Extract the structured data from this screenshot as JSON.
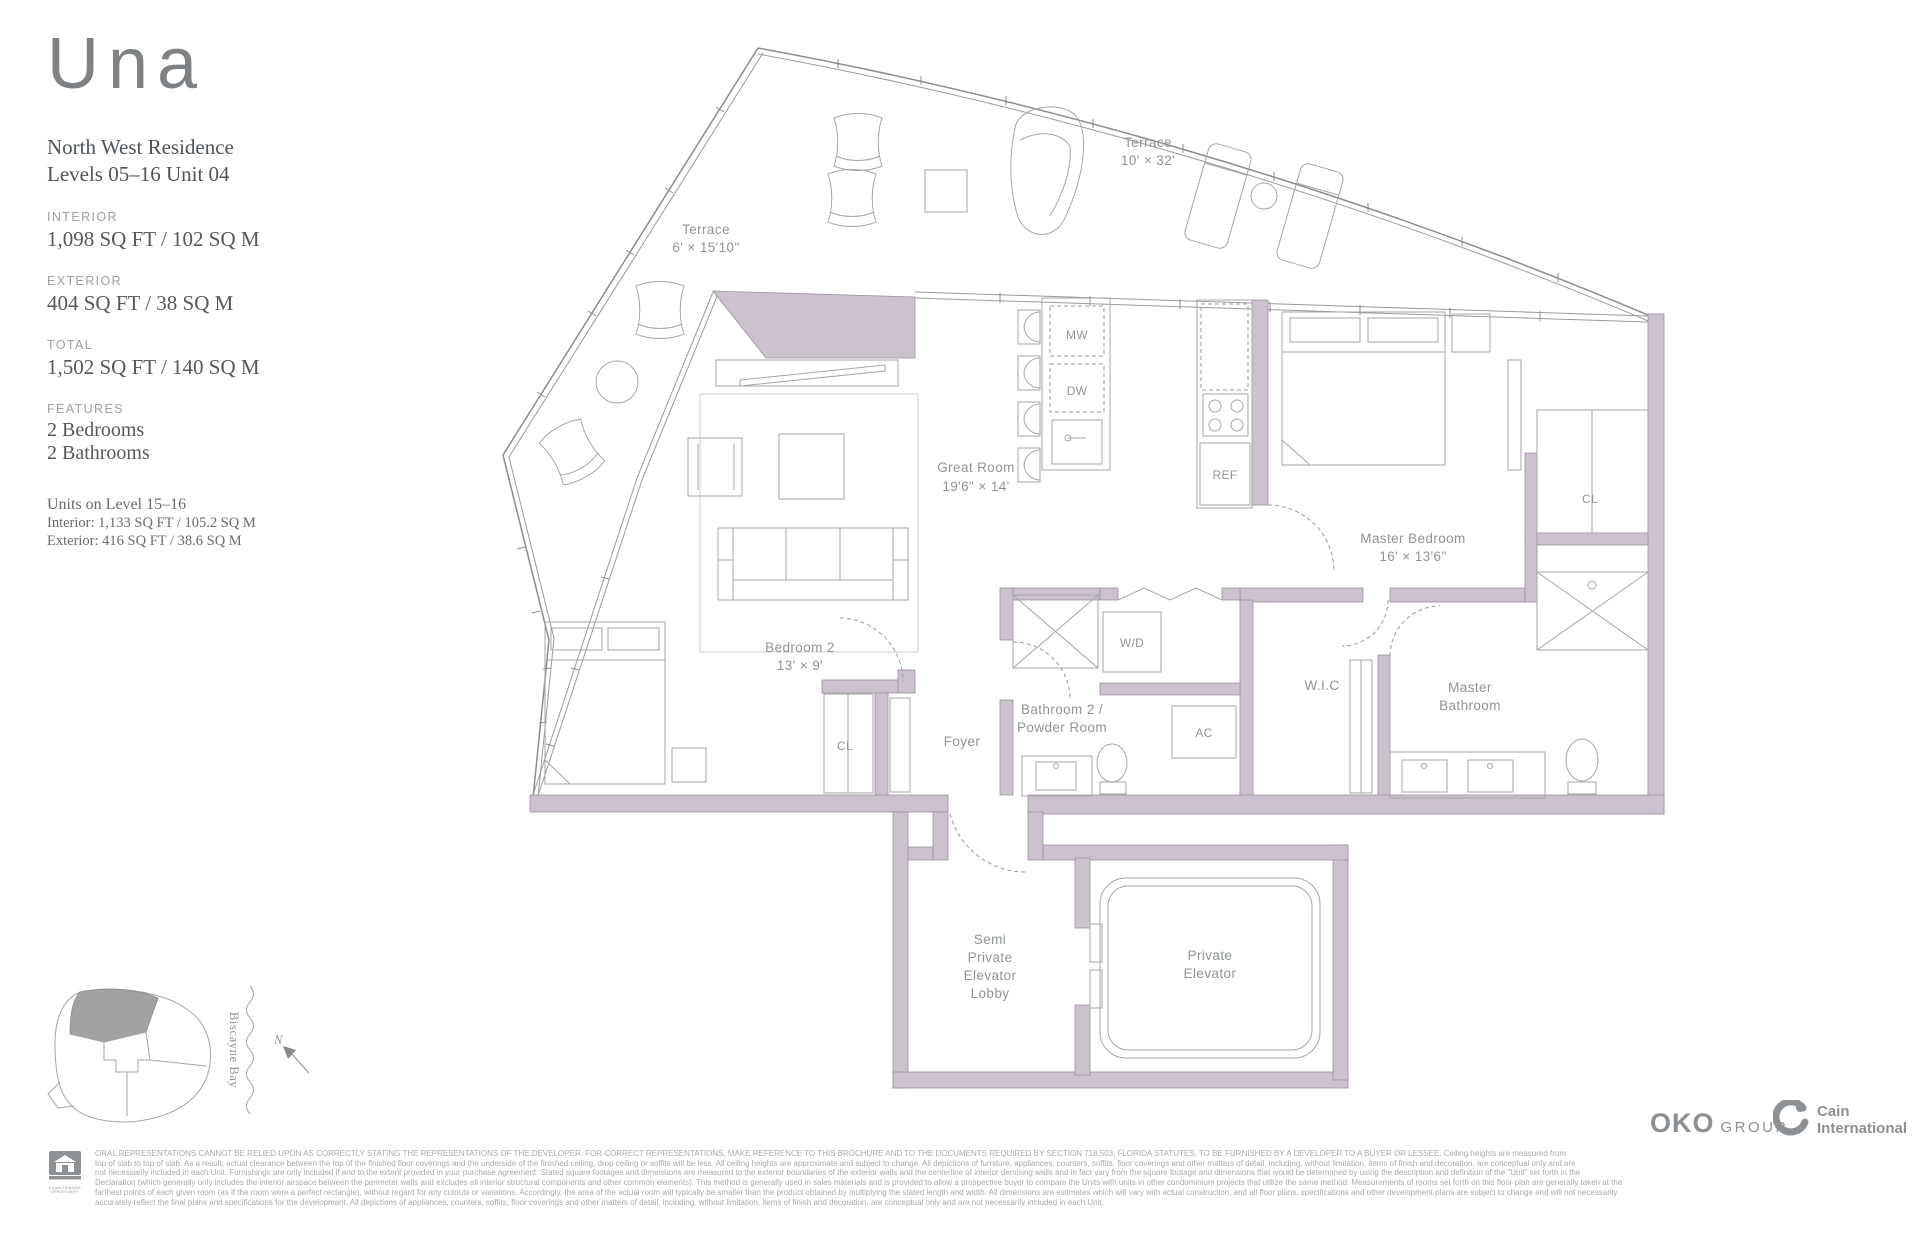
{
  "colors": {
    "wall_fill": "#ccc2cd",
    "line": "#9a9a9a",
    "label_text": "#8f9497",
    "panel_text": "#55595d"
  },
  "sidebar": {
    "logo": "Una",
    "residence_name": "North West Residence",
    "residence_levels": "Levels 05–16 Unit 04",
    "interior_label": "INTERIOR",
    "interior_value": "1,098 SQ FT / 102 SQ M",
    "exterior_label": "EXTERIOR",
    "exterior_value": "404 SQ FT / 38 SQ M",
    "total_label": "TOTAL",
    "total_value": "1,502 SQ FT / 140 SQ M",
    "features_label": "FEATURES",
    "feature_1": "2 Bedrooms",
    "feature_2": "2 Bathrooms",
    "units_note_title": "Units on Level 15–16",
    "units_note_interior": "Interior: 1,133 SQ FT / 105.2 SQ M",
    "units_note_exterior": "Exterior: 416 SQ FT / 38.6 SQ M"
  },
  "plan": {
    "terrace_left_name": "Terrace",
    "terrace_left_dim": "6' × 15'10\"",
    "terrace_top_name": "Terrace",
    "terrace_top_dim": "10' × 32'",
    "great_room_name": "Great Room",
    "great_room_dim": "19'6\" × 14'",
    "master_bedroom_name": "Master Bedroom",
    "master_bedroom_dim": "16' × 13'6\"",
    "bedroom2_name": "Bedroom 2",
    "bedroom2_dim": "13' × 9'",
    "mw": "MW",
    "dw": "DW",
    "ref": "REF",
    "wd": "W/D",
    "ac": "AC",
    "wic": "W.I.C",
    "cl_bedroom2": "CL",
    "cl_master": "CL",
    "foyer": "Foyer",
    "bath2_line1": "Bathroom 2 /",
    "bath2_line2": "Powder Room",
    "master_bath_line1": "Master",
    "master_bath_line2": "Bathroom",
    "lobby_line1": "Semi",
    "lobby_line2": "Private",
    "lobby_line3": "Elevator",
    "lobby_line4": "Lobby",
    "elevator_line1": "Private",
    "elevator_line2": "Elevator"
  },
  "site_map": {
    "bay_label": "Biscayne Bay",
    "north_label": "N"
  },
  "footer": {
    "oko_bold": "OKO",
    "oko_light": "GROUP",
    "cain_line1": "Cain",
    "cain_line2": "International",
    "equal_housing_1": "EQUAL HOUSING",
    "equal_housing_2": "OPPORTUNITY",
    "disclaimer_lines": [
      "ORAL REPRESENTATIONS CANNOT BE RELIED UPON AS CORRECTLY STATING THE REPRESENTATIONS OF THE DEVELOPER. FOR CORRECT REPRESENTATIONS, MAKE REFERENCE TO THIS BROCHURE AND TO THE DOCUMENTS REQUIRED BY SECTION 718.503, FLORIDA STATUTES, TO BE FURNISHED BY A DEVELOPER TO A BUYER OR LESSEE. Ceiling heights are measured from",
      "top of slab to top of slab. As a result, actual clearance between the top of the finished floor coverings and the underside of the finished ceiling, drop ceiling or soffits will be less. All ceiling heights are approximate and subject to change. All depictions of furniture, appliances, counters, soffits, floor coverings and other matters of detail, including, without limitation, items of finish and decoration, are conceptual only and are",
      "not necessarily included in each Unit. Furnishings are only included if and to the extent provided in your purchase agreement. Stated square footages and dimensions are measured to the exterior boundaries of the exterior walls and the centerline of interior demising walls and in fact vary from the square footage and dimensions that would be determined by using the description and definition of the \"Unit\" set forth in the",
      "Declaration (which generally only includes the interior airspace between the perimeter walls and excludes all interior structural components and other common elements). This method is generally used in sales materials and is provided to allow a prospective buyer to compare the Units with units in other condominium projects that utilize the same method. Measurements of rooms set forth on this floor plan are generally taken at the",
      "farthest points of each given room (as if the room were a perfect rectangle), without regard for any cutouts or variations. Accordingly, the area of the actual room will typically be smaller than the product obtained by multiplying the stated length and width. All dimensions are estimates which will vary with actual construction, and all floor plans, specifications and other development plans are subject to change and will not necessarily",
      "accurately reflect the final plans and specifications for the development. All depictions of appliances, counters, soffits, floor coverings and other matters of detail, including, without limitation, items of finish and decoration, are conceptual only and are not necessarily included in each Unit."
    ]
  }
}
